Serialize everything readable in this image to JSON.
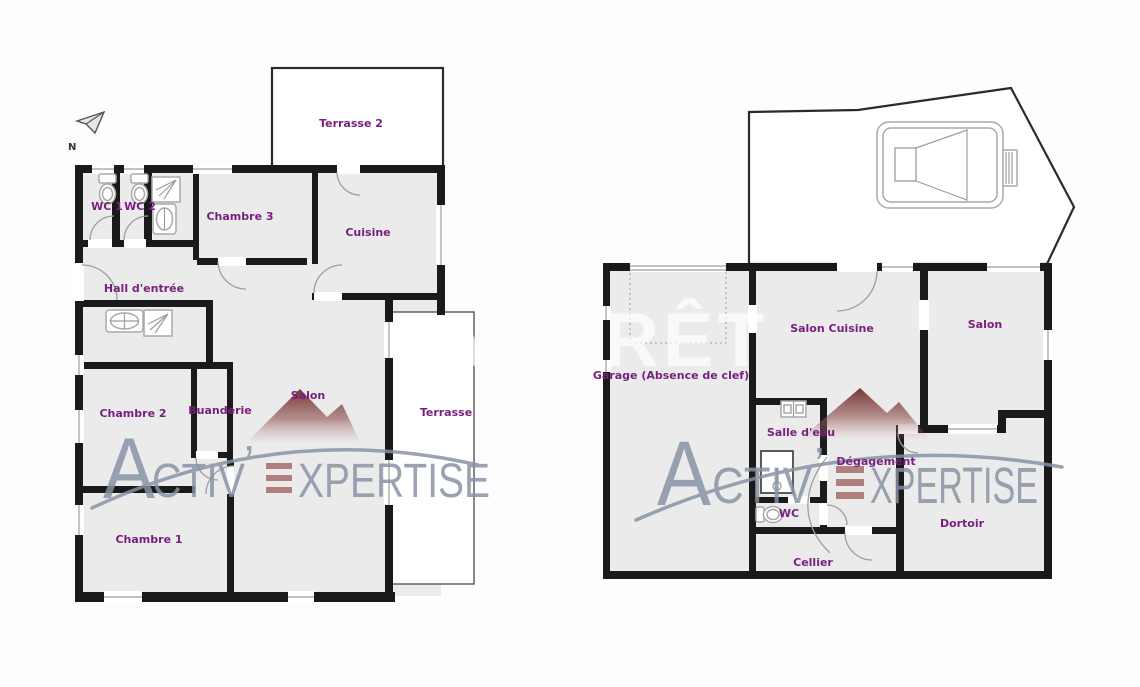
{
  "document": {
    "type_label": "floor-plan"
  },
  "compass": {
    "north_label": "N"
  },
  "watermarks": {
    "brand_full": "ACTIV'EXPERTISE",
    "brand_part_a": "A",
    "brand_part_ctiv": "CTIV",
    "brand_apostrophe": "’",
    "brand_part_xpertise": "XPERTISE",
    "faint_text": "LAFORÊT",
    "brand_color": "#8791a3",
    "accent_bar_color": "#a36a6a",
    "mountain_color": "#702b2b"
  },
  "colors": {
    "room_label": "#771f7e",
    "wall": "#1a1a1a",
    "floor": "#ebebeb",
    "fixture_outline": "#a9a9a9"
  },
  "plan_left": {
    "rooms": {
      "terrasse2": "Terrasse 2",
      "wc1": "WC 1",
      "wc2": "WC 2",
      "chambre3": "Chambre 3",
      "cuisine": "Cuisine",
      "hall": "Hall d'entrée",
      "chambre2": "Chambre 2",
      "buanderie": "Buanderie",
      "salon": "Salon",
      "terrasse": "Terrasse",
      "chambre1": "Chambre 1"
    }
  },
  "plan_right": {
    "rooms": {
      "garage": "Garage (Absence de clef)",
      "salon_cuisine": "Salon Cuisine",
      "salon": "Salon",
      "salle_eau": "Salle d'eau",
      "degagement": "Dégagement",
      "wc": "WC",
      "dortoir": "Dortoir",
      "cellier": "Cellier"
    }
  }
}
